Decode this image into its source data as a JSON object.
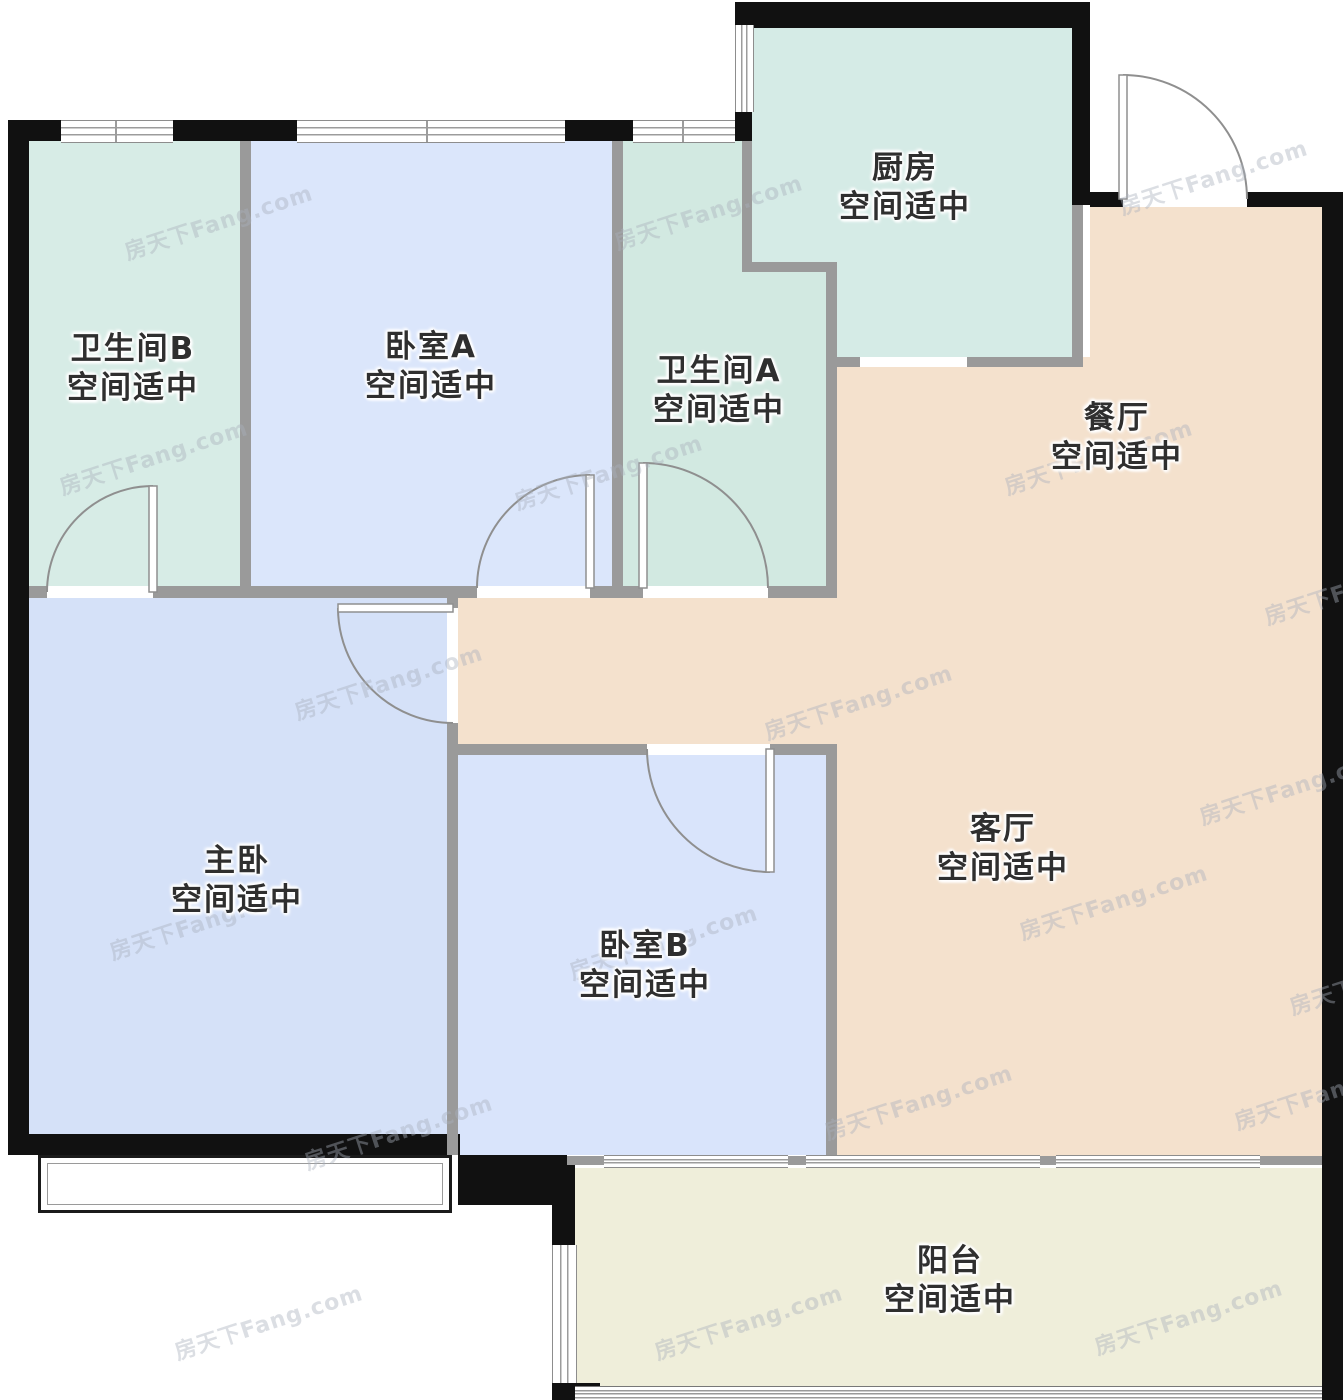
{
  "watermark": {
    "text": "房天下Fang.com"
  },
  "rooms": [
    {
      "id": "kitchen",
      "name": "厨房",
      "note": "空间适中"
    },
    {
      "id": "bathroom-b",
      "name": "卫生间B",
      "note": "空间适中"
    },
    {
      "id": "bedroom-a",
      "name": "卧室A",
      "note": "空间适中"
    },
    {
      "id": "bathroom-a",
      "name": "卫生间A",
      "note": "空间适中"
    },
    {
      "id": "dining-room",
      "name": "餐厅",
      "note": "空间适中"
    },
    {
      "id": "master-bedroom",
      "name": "主卧",
      "note": "空间适中"
    },
    {
      "id": "bedroom-b",
      "name": "卧室B",
      "note": "空间适中"
    },
    {
      "id": "living-room",
      "name": "客厅",
      "note": "空间适中"
    },
    {
      "id": "balcony",
      "name": "阳台",
      "note": "空间适中"
    }
  ],
  "colors": {
    "wall_outer": "#111111",
    "wall_inner": "#9a9a9a",
    "bathroom_b": "#d7ece6",
    "bathroom_a": "#d2e9e1",
    "kitchen": "#d5ebe6",
    "bedroom_a": "#dbe6fb",
    "master": "#d5e1f8",
    "bedroom_b": "#d9e4fb",
    "living": "#f4e1cd",
    "balcony": "#efeeda"
  }
}
